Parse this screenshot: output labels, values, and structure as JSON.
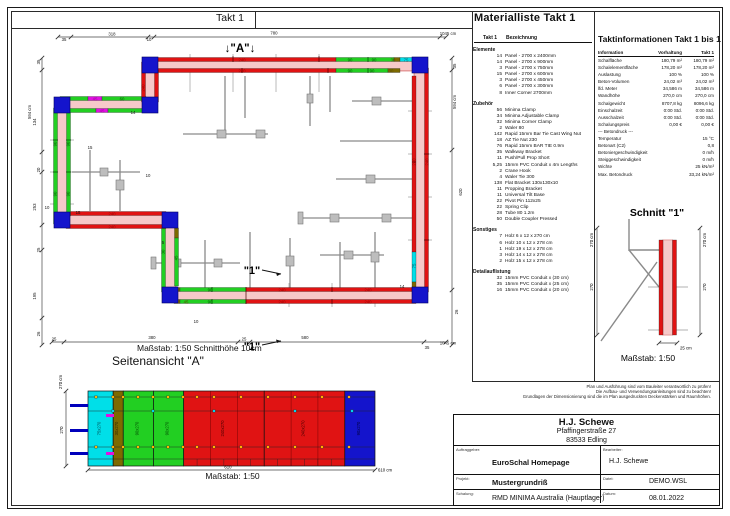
{
  "page": {
    "band_title": "Takt 1"
  },
  "colors": {
    "panel_red": "#e01313",
    "panel_green": "#22cf22",
    "panel_cyan": "#00dfe8",
    "panel_blue": "#1414cc",
    "panel_magenta": "#e011e0",
    "panel_olive": "#7d6a00",
    "concrete_pink": "#f6c9c9",
    "concrete_edge": "#e59a9a",
    "brace_gray": "#8a8a8a",
    "labels": {
      "R": "#9d0000",
      "G": "#005800",
      "BR": "#584a00",
      "C": "#00606a",
      "M": "#a000a0",
      "K": "#151515"
    }
  },
  "plan": {
    "frame_title": "Takt 1",
    "marker_a": "↓\"A\"↓",
    "marker_1": "\"1\"",
    "caption": "Maßstab: 1:50   Schnitthöhe 10cm",
    "labels": [
      {
        "t": "240",
        "x": 242,
        "y": 61.6,
        "c": "R"
      },
      {
        "t": "240",
        "x": 242,
        "y": 72.6,
        "c": "R"
      },
      {
        "t": "90",
        "x": 350,
        "y": 61.6,
        "c": "G"
      },
      {
        "t": "90",
        "x": 374,
        "y": 61.6,
        "c": "G"
      },
      {
        "t": "30",
        "x": 393,
        "y": 61.6,
        "c": "BR"
      },
      {
        "t": "90",
        "x": 350,
        "y": 72.6,
        "c": "G"
      },
      {
        "t": "90",
        "x": 372,
        "y": 72.6,
        "c": "G"
      },
      {
        "t": "30",
        "x": 391,
        "y": 72.6,
        "c": "BR"
      },
      {
        "t": "75",
        "x": 406,
        "y": 61.6,
        "c": "C"
      },
      {
        "t": "240",
        "x": 428.5,
        "y": 162,
        "r": -90,
        "c": "R"
      },
      {
        "t": "240",
        "x": 415.5,
        "y": 162,
        "r": -90,
        "c": "R"
      },
      {
        "t": "75",
        "x": 415.5,
        "y": 266,
        "r": -90,
        "c": "C"
      },
      {
        "t": "240",
        "x": 282,
        "y": 303.6,
        "c": "R"
      },
      {
        "t": "240",
        "x": 368,
        "y": 303.6,
        "c": "R"
      },
      {
        "t": "240",
        "x": 282,
        "y": 291.6,
        "c": "R"
      },
      {
        "t": "240",
        "x": 368,
        "y": 291.6,
        "c": "R"
      },
      {
        "t": "90",
        "x": 210,
        "y": 303.6,
        "c": "G"
      },
      {
        "t": "90",
        "x": 210,
        "y": 291.6,
        "c": "G"
      },
      {
        "t": "45",
        "x": 186,
        "y": 303.6,
        "c": "BR"
      },
      {
        "t": "30",
        "x": 164.5,
        "y": 252,
        "r": -90,
        "c": "G"
      },
      {
        "t": "45",
        "x": 177.5,
        "y": 258,
        "r": -90,
        "c": "G"
      },
      {
        "t": "240",
        "x": 112,
        "y": 228.6,
        "c": "R"
      },
      {
        "t": "240",
        "x": 112,
        "y": 215.6,
        "c": "R"
      },
      {
        "t": "90",
        "x": 56.5,
        "y": 144,
        "r": -90,
        "c": "G"
      },
      {
        "t": "90",
        "x": 69.5,
        "y": 144,
        "r": -90,
        "c": "G"
      },
      {
        "t": "90",
        "x": 56.5,
        "y": 194,
        "r": -90,
        "c": "G"
      },
      {
        "t": "90",
        "x": 69.5,
        "y": 194,
        "r": -90,
        "c": "G"
      },
      {
        "t": "45",
        "x": 95,
        "y": 100.6,
        "c": "M"
      },
      {
        "t": "60",
        "x": 122,
        "y": 100.6,
        "c": "G"
      },
      {
        "t": "45",
        "x": 102,
        "y": 112.6,
        "c": "M"
      },
      {
        "t": "240",
        "x": 144.5,
        "y": 88,
        "r": -90,
        "c": "R"
      },
      {
        "t": "10",
        "x": 148,
        "y": 177,
        "c": "K"
      },
      {
        "t": "14",
        "x": 133,
        "y": 114,
        "c": "K"
      },
      {
        "t": "15",
        "x": 90,
        "y": 149,
        "c": "K"
      },
      {
        "t": "10",
        "x": 47,
        "y": 209,
        "c": "K"
      },
      {
        "t": "15",
        "x": 78,
        "y": 214,
        "c": "K"
      },
      {
        "t": "10",
        "x": 196,
        "y": 323,
        "c": "K"
      },
      {
        "t": "5",
        "x": 163,
        "y": 244,
        "c": "K"
      },
      {
        "t": "14",
        "x": 402,
        "y": 288,
        "c": "K"
      },
      {
        "t": "35",
        "x": 64,
        "y": 41,
        "c": "K"
      },
      {
        "t": "318",
        "x": 112,
        "y": 35.6,
        "c": "K"
      },
      {
        "t": "10",
        "x": 149,
        "y": 41,
        "c": "K"
      },
      {
        "t": "780",
        "x": 274,
        "y": 34.6,
        "c": "K"
      },
      {
        "t": "1045 cm",
        "x": 448,
        "y": 35,
        "c": "K"
      },
      {
        "t": "594 cm",
        "x": 31,
        "y": 112,
        "r": -90,
        "c": "K"
      },
      {
        "t": "35",
        "x": 40,
        "y": 62,
        "r": -90,
        "c": "K"
      },
      {
        "t": "134",
        "x": 36,
        "y": 122,
        "r": -90,
        "c": "K"
      },
      {
        "t": "20",
        "x": 40,
        "y": 170,
        "r": -90,
        "c": "K"
      },
      {
        "t": "253",
        "x": 36,
        "y": 207,
        "r": -90,
        "c": "K"
      },
      {
        "t": "25",
        "x": 40,
        "y": 250,
        "r": -90,
        "c": "K"
      },
      {
        "t": "195",
        "x": 36,
        "y": 296,
        "r": -90,
        "c": "K"
      },
      {
        "t": "26",
        "x": 40,
        "y": 334,
        "r": -90,
        "c": "K"
      },
      {
        "t": "25",
        "x": 54,
        "y": 340.6,
        "c": "K"
      },
      {
        "t": "380",
        "x": 152,
        "y": 339,
        "c": "K"
      },
      {
        "t": "25",
        "x": 244,
        "y": 340.6,
        "c": "K"
      },
      {
        "t": "580",
        "x": 305,
        "y": 339,
        "c": "K"
      },
      {
        "t": "35",
        "x": 427,
        "y": 349,
        "c": "K"
      },
      {
        "t": "1045 cm",
        "x": 448,
        "y": 344.6,
        "c": "K"
      },
      {
        "t": "35",
        "x": 456,
        "y": 66,
        "r": -90,
        "c": "K"
      },
      {
        "t": "594 cm",
        "x": 456,
        "y": 102,
        "r": -90,
        "c": "K"
      },
      {
        "t": "620",
        "x": 462,
        "y": 192,
        "r": -90,
        "c": "K"
      },
      {
        "t": "26",
        "x": 458,
        "y": 312,
        "r": -90,
        "c": "K"
      }
    ]
  },
  "materialliste": {
    "title": "Materialliste  Takt 1",
    "col_qty": "Takt 1",
    "col_desc": "Bezeichnung",
    "groups": [
      {
        "name": "Elemente",
        "items": [
          {
            "qty": "14",
            "desc": "Panel - 2700 x 2400mm"
          },
          {
            "qty": "14",
            "desc": "Panel - 2700 x 900mm"
          },
          {
            "qty": "3",
            "desc": "Panel - 2700 x 750mm"
          },
          {
            "qty": "15",
            "desc": "Panel - 2700 x 600mm"
          },
          {
            "qty": "3",
            "desc": "Panel - 2700 x 450mm"
          },
          {
            "qty": "6",
            "desc": "Panel - 2700 x 300mm"
          },
          {
            "qty": "8",
            "desc": "Inner Corner 2700mm"
          }
        ]
      },
      {
        "name": "Zubehör",
        "items": [
          {
            "qty": "56",
            "desc": "Minima Clamp"
          },
          {
            "qty": "34",
            "desc": "Minima Adjustable Clamp"
          },
          {
            "qty": "32",
            "desc": "Minima Corner Clamp"
          },
          {
            "qty": "2",
            "desc": "Waler 80"
          },
          {
            "qty": "142",
            "desc": "Rapid 15mm Bar Tie Cast Wing Nut"
          },
          {
            "qty": "18",
            "desc": "AZ Tie Nut 230"
          },
          {
            "qty": "76",
            "desc": "Rapid 15mm BAR TIE 0.9m"
          },
          {
            "qty": "35",
            "desc": "Walkway Bracket"
          },
          {
            "qty": "11",
            "desc": "Push/Pull Prop Short"
          },
          {
            "qty": "5,25",
            "desc": "15mm PVC Conduit x 4m Lengths"
          },
          {
            "qty": "2",
            "desc": "Crane Hook"
          },
          {
            "qty": "4",
            "desc": "Waler Tie 300"
          },
          {
            "qty": "138",
            "desc": "Flat Bracket 130x130x10"
          },
          {
            "qty": "11",
            "desc": "Propping Bracket"
          },
          {
            "qty": "11",
            "desc": "Universal Tilt Base"
          },
          {
            "qty": "22",
            "desc": "Pivot Pin 112x25"
          },
          {
            "qty": "22",
            "desc": "Spring Clip"
          },
          {
            "qty": "28",
            "desc": "Tube 80 1.2m"
          },
          {
            "qty": "50",
            "desc": "Double Coupler Pressed"
          }
        ]
      },
      {
        "name": "Sonstiges",
        "items": [
          {
            "qty": "7",
            "desc": "Holz 6 x 12 x 270 cm"
          },
          {
            "qty": "6",
            "desc": "Holz 10 x 12 x 278 cm"
          },
          {
            "qty": "1",
            "desc": "Holz 19 x 12 x 278 cm"
          },
          {
            "qty": "3",
            "desc": "Holz 14 x 12 x 278 cm"
          },
          {
            "qty": "2",
            "desc": "Holz 15 x 12 x 278 cm"
          }
        ]
      },
      {
        "name": "Detailauflistung",
        "items": [
          {
            "qty": "32",
            "desc": "15mm PVC Conduit x  (30 cm)"
          },
          {
            "qty": "35",
            "desc": "15mm PVC Conduit x  (25 cm)"
          },
          {
            "qty": "16",
            "desc": "15mm PVC Conduit x  (20 cm)"
          }
        ]
      }
    ]
  },
  "taktinfo": {
    "title": "Taktinformationen  Takt 1 bis 1",
    "columns": [
      "Information",
      "Vorhaltung",
      "Takt 1"
    ],
    "rows": [
      [
        "Schalfläche",
        "180,79 m²",
        "180,79 m²"
      ],
      [
        "Schalelementfläche",
        "178,20 m²",
        "178,20 m²"
      ],
      [
        "Auslastung",
        "100 %",
        "100 %"
      ],
      [
        "Beton-Volumen",
        "24,02 m³",
        "24,02 m³"
      ],
      [
        "lfd. Meter",
        "34,586 m",
        "34,586 m"
      ],
      [
        "Wandhöhe",
        "270,0 cm",
        "270,0 cm"
      ],
      [
        "Schalgewicht",
        "8707,8 kg",
        "8096,6 kg"
      ],
      [
        "Einschalzeit",
        "0:00 Std.",
        "0:00 Std."
      ],
      [
        "Ausschalzeit",
        "0:00 Std.",
        "0:00 Std."
      ],
      [
        "Schalungspreis",
        "0,00 €",
        "0,00 €"
      ],
      [
        "--- Betondruck ---",
        "",
        ""
      ],
      [
        "Temperatur",
        "",
        "15 °C"
      ],
      [
        "Betonart (C2)",
        "",
        "0,8"
      ],
      [
        "Betoniergeschwindigkeit",
        "",
        "0 m/h"
      ],
      [
        "Steiggeschwindigkeit",
        "",
        "0 m/h"
      ],
      [
        "Wichte",
        "",
        "25 kN/m³"
      ],
      [
        "Max. Betondruck",
        "",
        "33,24 kN/m²"
      ]
    ]
  },
  "schnitt": {
    "title": "Schnitt \"1\"",
    "dim_left_total": "270 cm",
    "dim_left": "270",
    "dim_right_total": "270 cm",
    "dim_right": "270",
    "dim_bottom": "25 cm",
    "caption": "Maßstab: 1:50"
  },
  "seitenansicht": {
    "title": "Seitenansicht \"A\"",
    "caption": "Maßstab: 1:50",
    "dim_height_total": "270 cm",
    "dim_height": "270",
    "dim_width": "610",
    "dim_width_total": "610 cm",
    "panels": [
      {
        "w": 75,
        "label": "75x270",
        "color": "panel_cyan",
        "lc": "#00484e"
      },
      {
        "w": 30,
        "label": "30x270",
        "color": "panel_olive",
        "lc": "#2e2800"
      },
      {
        "w": 90,
        "label": "90x270",
        "color": "panel_green",
        "lc": "#004400"
      },
      {
        "w": 90,
        "label": "90x270",
        "color": "panel_green",
        "lc": "#004400"
      },
      {
        "w": 240,
        "label": "240x270",
        "color": "panel_red",
        "lc": "#3c0000"
      },
      {
        "w": 240,
        "label": "240x270",
        "color": "panel_red",
        "lc": "#3c0000"
      },
      {
        "w": 90,
        "label": "90x270",
        "color": "panel_blue",
        "lc": "#00003a"
      }
    ]
  },
  "disclaimer": [
    "Plan und Ausführung sind vom Bauleiter verantwortlich zu prüfen!",
    "Die Aufbau- und Verwendungsanleitungen sind zu beachten!",
    "Grundlagen der Dimensionierung sind die im Plan ausgedruckten Deckenstärken und Raumhöhen."
  ],
  "titleblock": {
    "company": "H.J. Schewe",
    "street": "Pfaffingerstraße 27",
    "city": "83533 Edling",
    "client_label": "Auftraggeber:",
    "client": "EuroSchal Homepage",
    "editor_label": "Bearbeiter:",
    "editor": "H.J. Schewe",
    "project_label": "Projekt:",
    "project": "Mustergrundriß",
    "file_label": "Datei:",
    "file": "DEMO.WSL",
    "formwork_label": "Schalung:",
    "formwork": "RMD MINIMA Australia (Hauptlager)",
    "date_label": "Datum:",
    "date": "08.01.2022"
  }
}
